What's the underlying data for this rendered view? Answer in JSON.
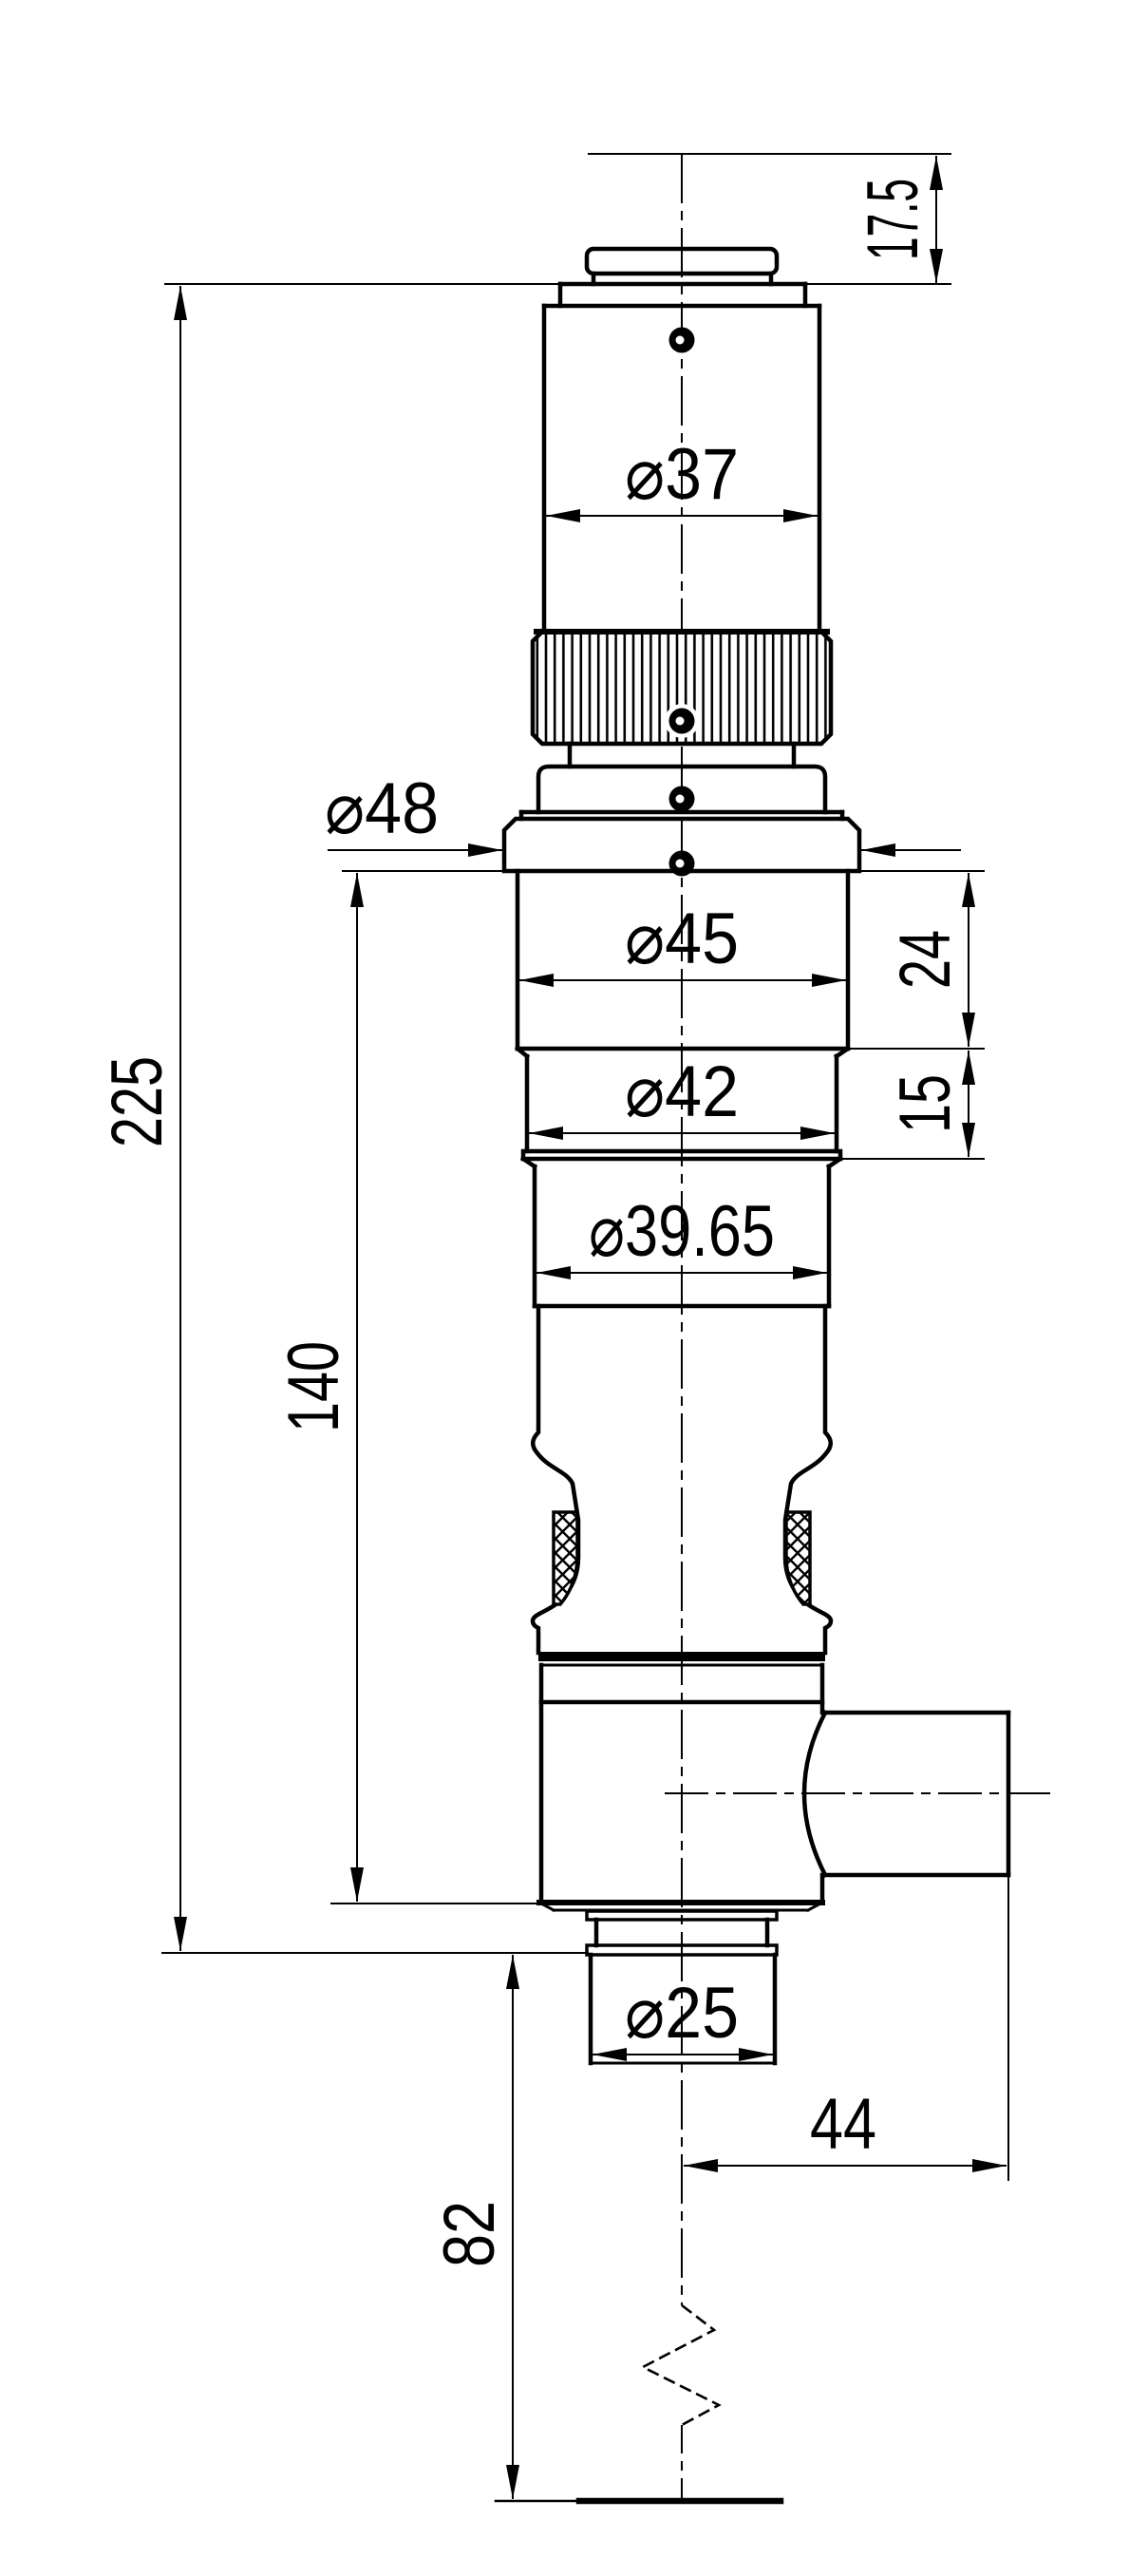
{
  "drawing": {
    "kind": "engineering-dimension-drawing",
    "background": "#ffffff",
    "line_color": "#000000",
    "labels": {
      "height_top": "17.5",
      "dia_body": "⌀37",
      "dia_flange": "⌀48",
      "dia_section_45": "⌀45",
      "height_section_45": "24",
      "dia_section_42": "⌀42",
      "height_section_42": "15",
      "dia_section_3965": "⌀39.65",
      "height_total": "225",
      "height_flange_to_base": "140",
      "dia_barrel": "⌀25",
      "width_port": "44",
      "height_bottom": "82"
    }
  }
}
